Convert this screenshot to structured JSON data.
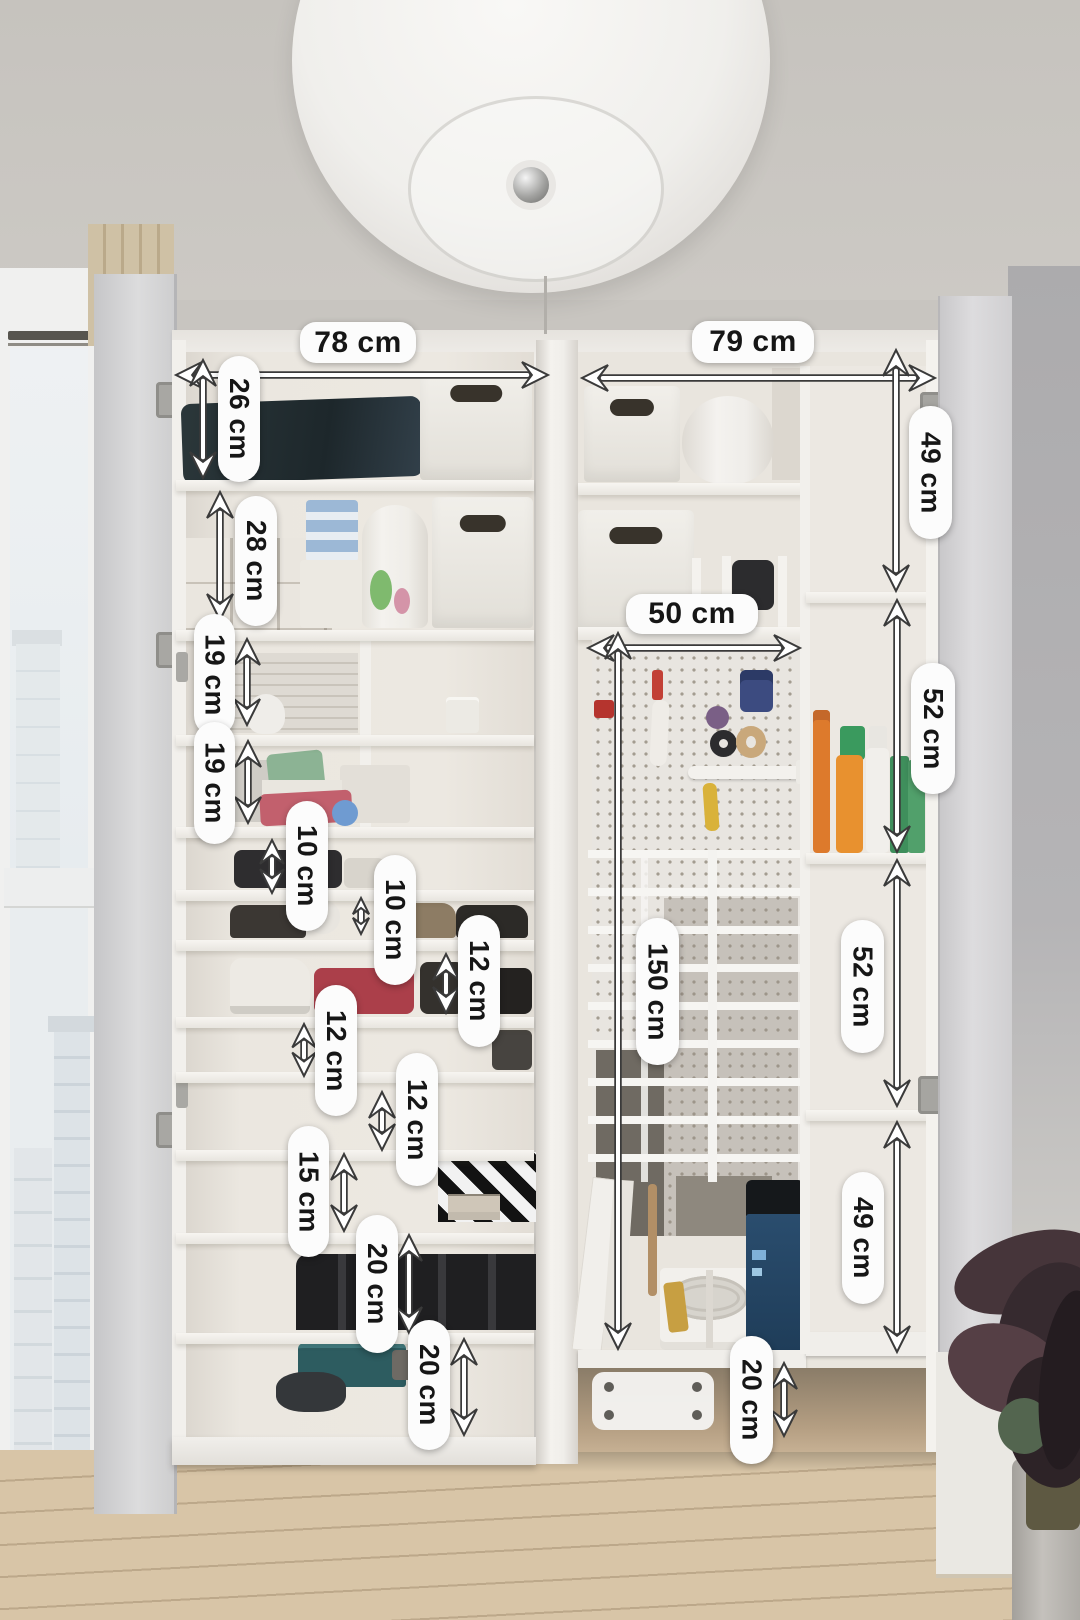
{
  "annotation_style": {
    "pill_bg": "#fcfcfc",
    "pill_text": "#161616",
    "arrow_fill": "#ffffff",
    "arrow_outline": "#3a3a3a"
  },
  "measurements": [
    {
      "id": "left-width",
      "text": "78 cm",
      "orientation": "horizontal",
      "pill": {
        "x": 300,
        "y": 322,
        "w": 116,
        "h": 41
      },
      "arrow": {
        "x1": 176,
        "y1": 375,
        "x2": 548,
        "y2": 375
      }
    },
    {
      "id": "right-width",
      "text": "79 cm",
      "orientation": "horizontal",
      "pill": {
        "x": 692,
        "y": 321,
        "w": 122,
        "h": 42
      },
      "arrow": {
        "x1": 582,
        "y1": 378,
        "x2": 935,
        "y2": 378
      }
    },
    {
      "id": "inner-width",
      "text": "50 cm",
      "orientation": "horizontal",
      "pill": {
        "x": 626,
        "y": 594,
        "w": 132,
        "h": 40
      },
      "arrow": {
        "x1": 588,
        "y1": 648,
        "x2": 800,
        "y2": 648
      }
    },
    {
      "id": "sec-26",
      "text": "26 cm",
      "orientation": "vertical",
      "pill": {
        "x": 218,
        "y": 356,
        "w": 42,
        "h": 126
      },
      "arrow": {
        "x1": 203,
        "y1": 360,
        "x2": 203,
        "y2": 478
      }
    },
    {
      "id": "sec-28",
      "text": "28 cm",
      "orientation": "vertical",
      "pill": {
        "x": 235,
        "y": 496,
        "w": 42,
        "h": 130
      },
      "arrow": {
        "x1": 220,
        "y1": 492,
        "x2": 220,
        "y2": 620
      }
    },
    {
      "id": "sec-19a",
      "text": "19 cm",
      "orientation": "vertical",
      "pill": {
        "x": 194,
        "y": 614,
        "w": 41,
        "h": 122
      },
      "arrow": {
        "x1": 247,
        "y1": 639,
        "x2": 247,
        "y2": 725
      }
    },
    {
      "id": "sec-19b",
      "text": "19 cm",
      "orientation": "vertical",
      "pill": {
        "x": 194,
        "y": 722,
        "w": 41,
        "h": 122
      },
      "arrow": {
        "x1": 248,
        "y1": 741,
        "x2": 248,
        "y2": 823
      }
    },
    {
      "id": "sec-10a",
      "text": "10 cm",
      "orientation": "vertical",
      "pill": {
        "x": 286,
        "y": 801,
        "w": 42,
        "h": 130
      },
      "arrow": {
        "x1": 272,
        "y1": 840,
        "x2": 272,
        "y2": 893
      }
    },
    {
      "id": "sec-10b",
      "text": "10 cm",
      "orientation": "vertical",
      "pill": {
        "x": 374,
        "y": 855,
        "w": 42,
        "h": 130
      },
      "arrow": {
        "x1": 361,
        "y1": 898,
        "x2": 361,
        "y2": 934
      }
    },
    {
      "id": "sec-12a",
      "text": "12 cm",
      "orientation": "vertical",
      "pill": {
        "x": 458,
        "y": 915,
        "w": 42,
        "h": 132
      },
      "arrow": {
        "x1": 446,
        "y1": 954,
        "x2": 446,
        "y2": 1013
      }
    },
    {
      "id": "sec-12b",
      "text": "12 cm",
      "orientation": "vertical",
      "pill": {
        "x": 315,
        "y": 985,
        "w": 42,
        "h": 131
      },
      "arrow": {
        "x1": 304,
        "y1": 1024,
        "x2": 304,
        "y2": 1076
      }
    },
    {
      "id": "sec-12c",
      "text": "12 cm",
      "orientation": "vertical",
      "pill": {
        "x": 396,
        "y": 1053,
        "w": 42,
        "h": 133
      },
      "arrow": {
        "x1": 382,
        "y1": 1092,
        "x2": 382,
        "y2": 1150
      }
    },
    {
      "id": "sec-15",
      "text": "15 cm",
      "orientation": "vertical",
      "pill": {
        "x": 288,
        "y": 1126,
        "w": 41,
        "h": 131
      },
      "arrow": {
        "x1": 344,
        "y1": 1154,
        "x2": 344,
        "y2": 1231
      }
    },
    {
      "id": "sec-20a",
      "text": "20 cm",
      "orientation": "vertical",
      "pill": {
        "x": 356,
        "y": 1215,
        "w": 42,
        "h": 138
      },
      "arrow": {
        "x1": 409,
        "y1": 1235,
        "x2": 409,
        "y2": 1333
      }
    },
    {
      "id": "sec-20b",
      "text": "20 cm",
      "orientation": "vertical",
      "pill": {
        "x": 408,
        "y": 1320,
        "w": 42,
        "h": 130
      },
      "arrow": {
        "x1": 464,
        "y1": 1339,
        "x2": 464,
        "y2": 1435
      }
    },
    {
      "id": "col-49a",
      "text": "49 cm",
      "orientation": "vertical",
      "pill": {
        "x": 909,
        "y": 406,
        "w": 43,
        "h": 133
      },
      "arrow": {
        "x1": 896,
        "y1": 350,
        "x2": 896,
        "y2": 591
      }
    },
    {
      "id": "col-52a",
      "text": "52 cm",
      "orientation": "vertical",
      "pill": {
        "x": 911,
        "y": 663,
        "w": 44,
        "h": 131
      },
      "arrow": {
        "x1": 897,
        "y1": 600,
        "x2": 897,
        "y2": 852
      }
    },
    {
      "id": "col-52b",
      "text": "52 cm",
      "orientation": "vertical",
      "pill": {
        "x": 841,
        "y": 920,
        "w": 43,
        "h": 133
      },
      "arrow": {
        "x1": 897,
        "y1": 860,
        "x2": 897,
        "y2": 1106
      }
    },
    {
      "id": "col-49b",
      "text": "49 cm",
      "orientation": "vertical",
      "pill": {
        "x": 842,
        "y": 1172,
        "w": 42,
        "h": 132
      },
      "arrow": {
        "x1": 897,
        "y1": 1122,
        "x2": 897,
        "y2": 1352
      }
    },
    {
      "id": "rack-150",
      "text": "150 cm",
      "orientation": "vertical",
      "pill": {
        "x": 636,
        "y": 918,
        "w": 43,
        "h": 147
      },
      "arrow": {
        "x1": 618,
        "y1": 633,
        "x2": 618,
        "y2": 1349
      }
    },
    {
      "id": "plinth-20",
      "text": "20 cm",
      "orientation": "vertical",
      "pill": {
        "x": 730,
        "y": 1336,
        "w": 43,
        "h": 128
      },
      "arrow": {
        "x1": 784,
        "y1": 1363,
        "x2": 784,
        "y2": 1436
      }
    }
  ]
}
